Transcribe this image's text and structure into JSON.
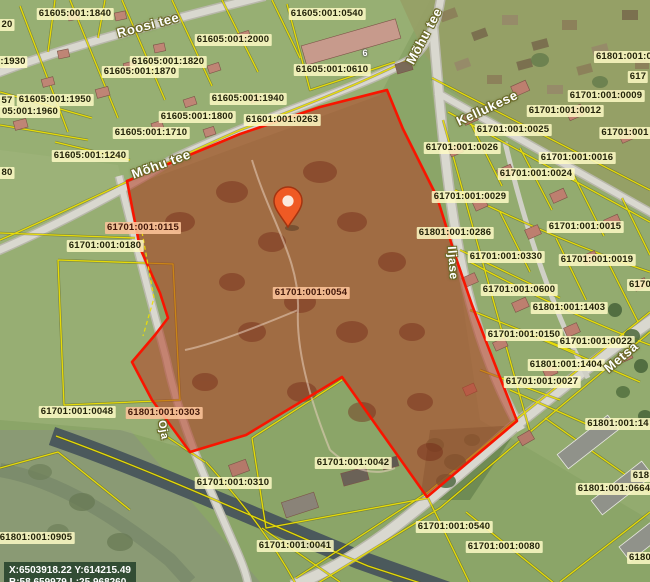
{
  "map": {
    "coordinates": {
      "line1": "X:6503918.22 Y:614215.49",
      "line2": "B:58.659979 L:25.968260"
    },
    "highlighted_parcel": {
      "code": "61701:001:0054",
      "outline_color": "#f81500",
      "fill_color": "rgba(178,62,36,0.55)"
    },
    "pin": {
      "color": "#ef5a24"
    },
    "cadastral_line_color": "#ecdf05",
    "parcel_labels": [
      {
        "text": "61605:001:1840",
        "x": 75,
        "y": 14,
        "style": "normal"
      },
      {
        "text": "61605:001:2000",
        "x": 233,
        "y": 40,
        "style": "normal"
      },
      {
        "text": "61605:001:1820",
        "x": 168,
        "y": 62,
        "style": "normal"
      },
      {
        "text": "61605:001:1870",
        "x": 140,
        "y": 72,
        "style": "normal"
      },
      {
        "text": "61605:001:1950",
        "x": 55,
        "y": 100,
        "style": "normal"
      },
      {
        "text": "61605:001:1940",
        "x": 248,
        "y": 99,
        "style": "normal"
      },
      {
        "text": "61605:001:1800",
        "x": 197,
        "y": 117,
        "style": "normal"
      },
      {
        "text": "61601:001:0263",
        "x": 282,
        "y": 120,
        "style": "normal"
      },
      {
        "text": "61605:001:1710",
        "x": 151,
        "y": 133,
        "style": "normal"
      },
      {
        "text": "61605:001:1240",
        "x": 90,
        "y": 156,
        "style": "normal"
      },
      {
        "text": "61605:001:0540",
        "x": 327,
        "y": 14,
        "style": "normal"
      },
      {
        "text": "61605:001:0610",
        "x": 332,
        "y": 70,
        "style": "normal"
      },
      {
        "text": "61701:001:0012",
        "x": 565,
        "y": 111,
        "style": "normal"
      },
      {
        "text": "61701:001:0025",
        "x": 513,
        "y": 130,
        "style": "normal"
      },
      {
        "text": "61701:001:0026",
        "x": 462,
        "y": 148,
        "style": "normal"
      },
      {
        "text": "61701:001:0016",
        "x": 577,
        "y": 158,
        "style": "normal"
      },
      {
        "text": "61701:001:0024",
        "x": 536,
        "y": 174,
        "style": "normal"
      },
      {
        "text": "61701:001:0029",
        "x": 470,
        "y": 197,
        "style": "normal"
      },
      {
        "text": "61701:001:0015",
        "x": 585,
        "y": 227,
        "style": "normal"
      },
      {
        "text": "61801:001:0286",
        "x": 455,
        "y": 233,
        "style": "normal"
      },
      {
        "text": "61701:001:0330",
        "x": 506,
        "y": 257,
        "style": "normal"
      },
      {
        "text": "61701:001:0019",
        "x": 597,
        "y": 260,
        "style": "normal"
      },
      {
        "text": "61701:001:0600",
        "x": 519,
        "y": 290,
        "style": "normal"
      },
      {
        "text": "61801:001:1403",
        "x": 569,
        "y": 308,
        "style": "normal"
      },
      {
        "text": "61701:001:0150",
        "x": 524,
        "y": 335,
        "style": "normal"
      },
      {
        "text": "61701:001:0022",
        "x": 596,
        "y": 342,
        "style": "normal"
      },
      {
        "text": "61801:001:1404",
        "x": 566,
        "y": 365,
        "style": "normal"
      },
      {
        "text": "61701:001:0027",
        "x": 542,
        "y": 382,
        "style": "normal"
      },
      {
        "text": "61701:001:0180",
        "x": 105,
        "y": 246,
        "style": "normal"
      },
      {
        "text": "61701:001:0115",
        "x": 143,
        "y": 228,
        "style": "highlight"
      },
      {
        "text": "61701:001:0054",
        "x": 311,
        "y": 293,
        "style": "highlight"
      },
      {
        "text": "61701:001:0048",
        "x": 77,
        "y": 412,
        "style": "normal"
      },
      {
        "text": "61801:001:0303",
        "x": 164,
        "y": 413,
        "style": "highlight"
      },
      {
        "text": "61801:001:0905",
        "x": 36,
        "y": 538,
        "style": "normal"
      },
      {
        "text": "61701:001:0310",
        "x": 233,
        "y": 483,
        "style": "normal"
      },
      {
        "text": "61701:001:0041",
        "x": 295,
        "y": 546,
        "style": "normal"
      },
      {
        "text": "61701:001:0042",
        "x": 353,
        "y": 463,
        "style": "normal"
      },
      {
        "text": "61701:001:0540",
        "x": 454,
        "y": 527,
        "style": "normal"
      },
      {
        "text": "61701:001:0080",
        "x": 504,
        "y": 547,
        "style": "normal"
      },
      {
        "text": "61801:001:0664",
        "x": 614,
        "y": 489,
        "style": "normal"
      },
      {
        "text": "61801:001:14",
        "x": 618,
        "y": 424,
        "style": "normal"
      },
      {
        "text": "61701:001:0009",
        "x": 606,
        "y": 96,
        "style": "normal"
      },
      {
        "text": "20",
        "x": 7,
        "y": 25,
        "style": "normal"
      },
      {
        "text": ":1930",
        "x": 13,
        "y": 62,
        "style": "normal"
      },
      {
        "text": "57",
        "x": 7,
        "y": 101,
        "style": "normal"
      },
      {
        "text": "05:001:1960",
        "x": 30,
        "y": 112,
        "style": "normal"
      },
      {
        "text": "80",
        "x": 7,
        "y": 173,
        "style": "normal"
      },
      {
        "text": "61801:001:0",
        "x": 624,
        "y": 57,
        "style": "normal"
      },
      {
        "text": "617",
        "x": 638,
        "y": 77,
        "style": "normal"
      },
      {
        "text": "61701:001",
        "x": 625,
        "y": 133,
        "style": "normal"
      },
      {
        "text": "6170",
        "x": 640,
        "y": 285,
        "style": "normal"
      },
      {
        "text": "618",
        "x": 641,
        "y": 476,
        "style": "normal"
      },
      {
        "text": "6180",
        "x": 640,
        "y": 558,
        "style": "normal"
      }
    ],
    "street_labels": [
      {
        "text": "Roosi tee",
        "x": 148,
        "y": 25,
        "rot": -15,
        "size": 13
      },
      {
        "text": "Mõhu tee",
        "x": 424,
        "y": 36,
        "rot": -62,
        "size": 13
      },
      {
        "text": "Mõhu tee",
        "x": 161,
        "y": 164,
        "rot": -20,
        "size": 13
      },
      {
        "text": "Kellukese",
        "x": 487,
        "y": 108,
        "rot": -25,
        "size": 13
      },
      {
        "text": "Iljase",
        "x": 453,
        "y": 263,
        "rot": 86,
        "size": 12
      },
      {
        "text": "Metsa",
        "x": 621,
        "y": 357,
        "rot": -40,
        "size": 13
      },
      {
        "text": "Oja",
        "x": 163,
        "y": 430,
        "rot": 80,
        "size": 11
      }
    ],
    "building_labels": [
      {
        "text": "6",
        "x": 365,
        "y": 53
      }
    ]
  }
}
